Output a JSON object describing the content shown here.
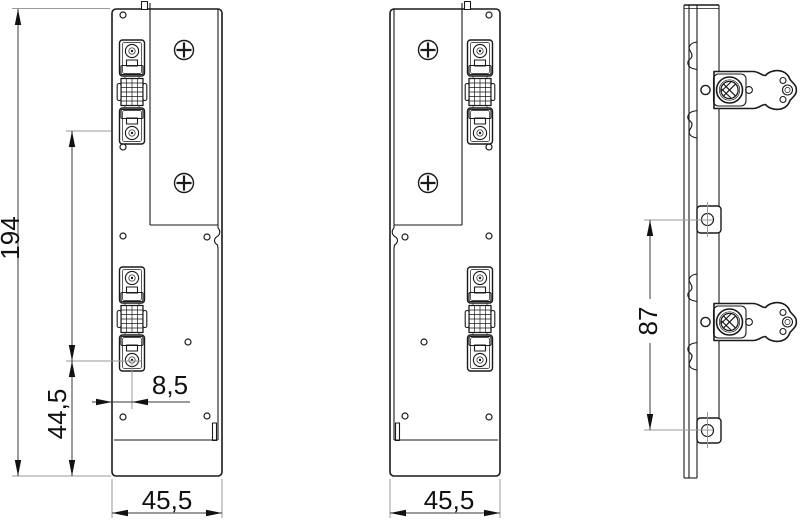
{
  "drawing": {
    "kind": "technical-drawing",
    "background": "#ffffff",
    "colors": {
      "line": "#1a1a1a",
      "dimension": "#3a3a3a",
      "extension": "#9a9a9a"
    },
    "views": {
      "front_right": "front view right-hand",
      "front_left": "front view left-hand mirrored",
      "side": "side view"
    }
  },
  "dimensions": {
    "overall_height": "194",
    "hinge_pivot_to_bottom": "44,5",
    "edge_to_hinge_axis": "8,5",
    "front_view_width": "45,5",
    "mirrored_view_width": "45,5",
    "side_tab_hole_spacing": "87"
  }
}
